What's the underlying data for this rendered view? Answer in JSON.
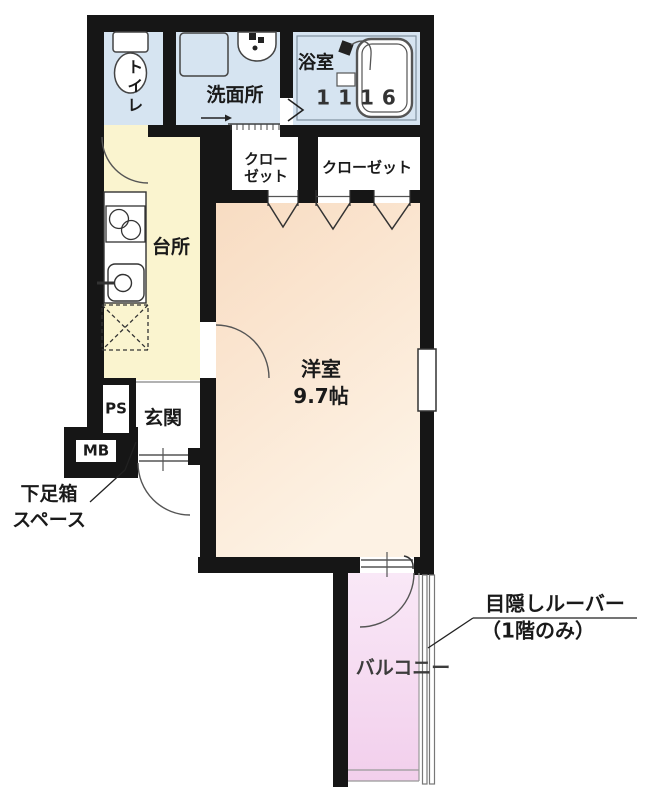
{
  "rooms": {
    "toilet": {
      "label": "トイレ"
    },
    "washroom": {
      "label": "洗面所"
    },
    "bathroom": {
      "label": "浴室",
      "size": "1116"
    },
    "closet_small": {
      "line1": "クロー",
      "line2": "ゼット"
    },
    "closet_large": {
      "label": "クローゼット"
    },
    "kitchen": {
      "label": "台所"
    },
    "western_room": {
      "label": "洋室",
      "size": "9.7帖"
    },
    "entrance": {
      "label": "玄関"
    },
    "pipe_shaft": {
      "label": "PS"
    },
    "meter_box": {
      "label": "MB"
    },
    "balcony": {
      "label": "バルコニー"
    }
  },
  "annotations": {
    "shoe_box_space": {
      "line1": "下足箱",
      "line2": "スペース"
    },
    "privacy_louver": {
      "line1": "目隠しルーバー",
      "line2": "（1階のみ）"
    }
  },
  "colors": {
    "wall": "#161616",
    "wet_area_fill": "#d6e4f1",
    "kitchen_fill": "#faf4cf",
    "western_room_gradient": [
      "#f8dcc2",
      "#fdf2e4"
    ],
    "balcony_gradient": [
      "#f9e8f7",
      "#f2cfec"
    ],
    "line": "#555555"
  }
}
